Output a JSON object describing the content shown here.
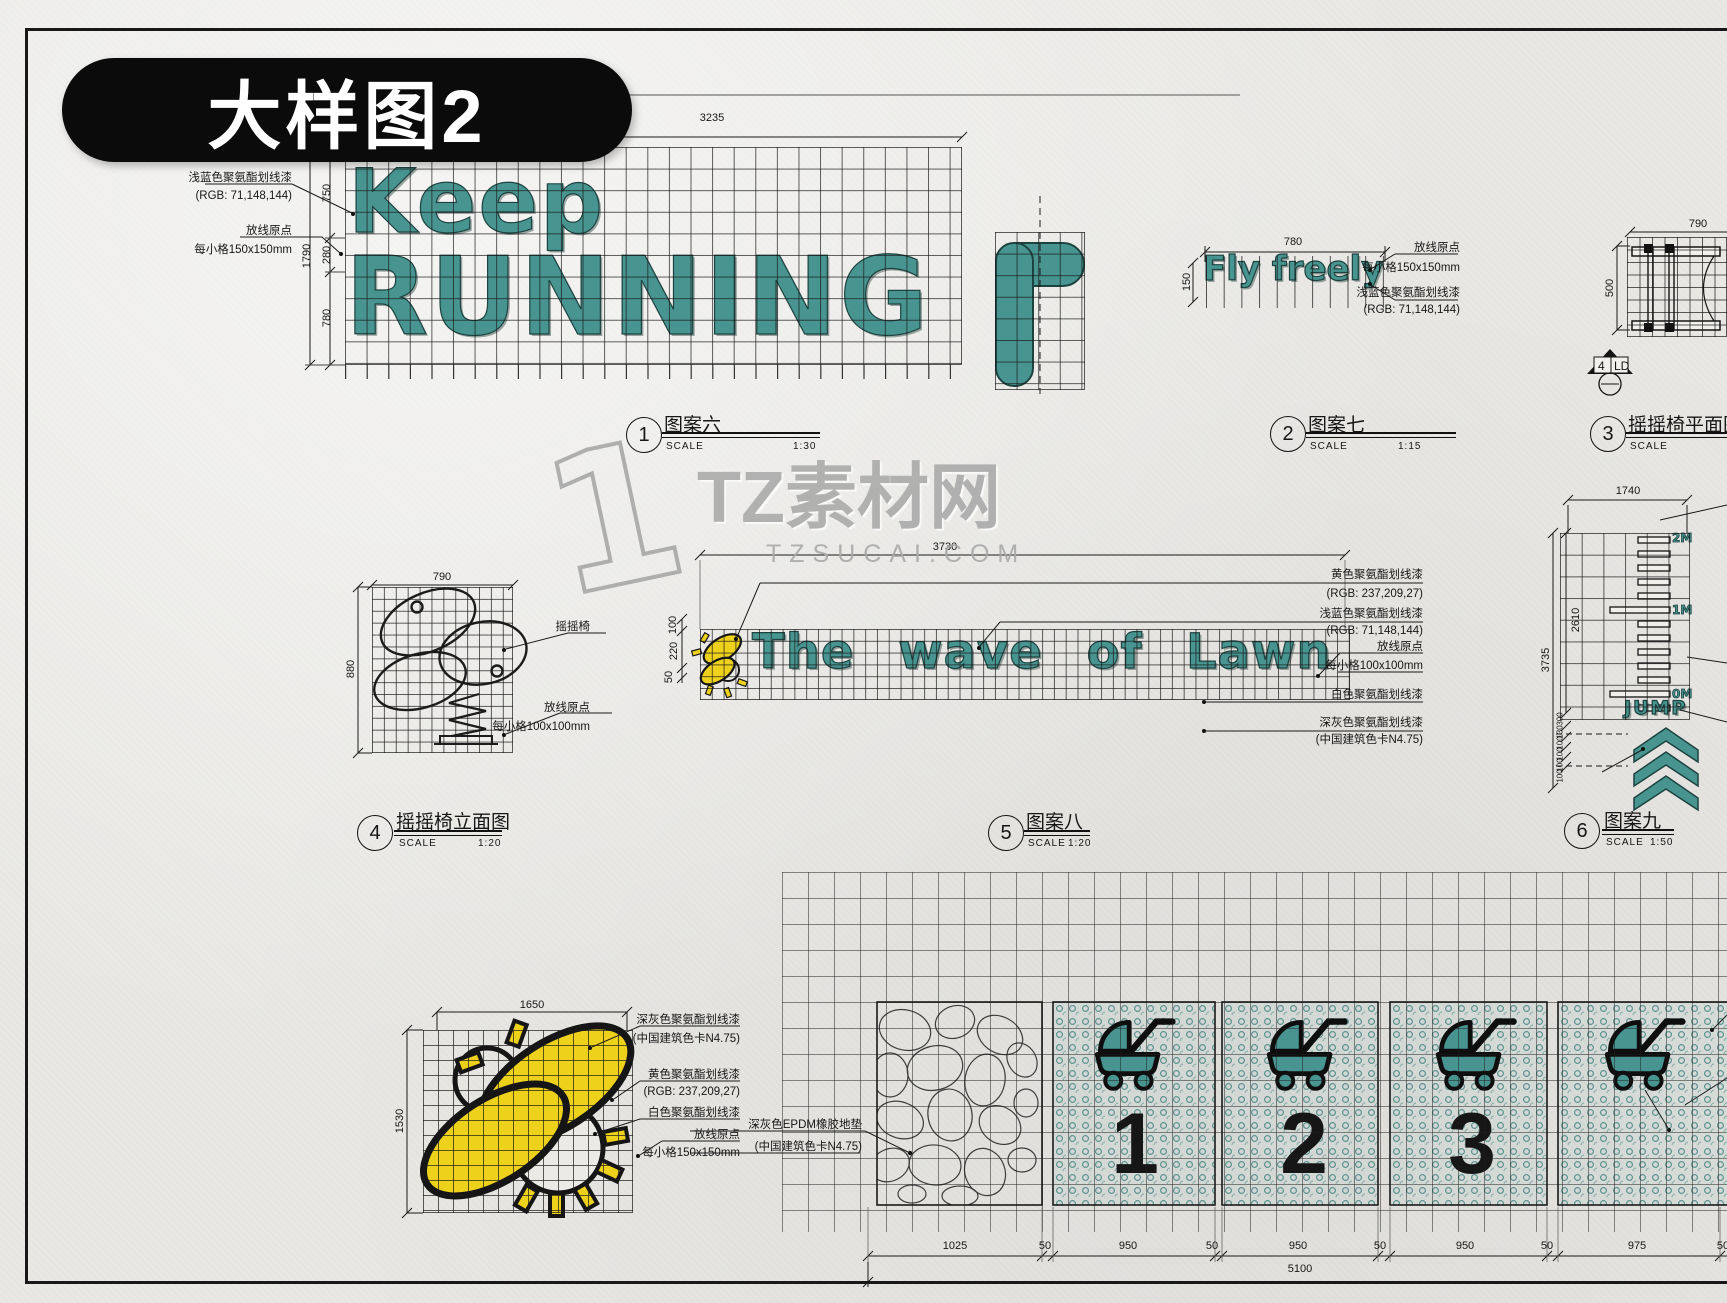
{
  "sheet": {
    "title": "大样图2"
  },
  "watermark": {
    "numeral": "1",
    "brand": "TZ素材网",
    "domain": "TZSUCAI.COM"
  },
  "colors": {
    "teal": "#479490",
    "yellow": "#edd11b",
    "paper": "#e9e8e5",
    "ink": "#161616"
  },
  "scale_word": "SCALE",
  "d1": {
    "num": "1",
    "title": "图案六",
    "scale": "1:30",
    "line1": "Keep",
    "line2": "RUNNING",
    "dim_top": "3235",
    "dim_750": "750",
    "dim_280": "280",
    "dim_780": "780",
    "dim_1790": "1790",
    "ann": [
      "浅蓝色聚氨酯划线漆",
      "(RGB: 71,148,144)",
      "放线原点",
      "每小格150x150mm"
    ]
  },
  "d2": {
    "num": "2",
    "title": "图案七",
    "scale": "1:15",
    "text": "Fly freely",
    "dim_top": "780",
    "dim_left": "150",
    "ann": [
      "放线原点",
      "每小格150x150mm",
      "浅蓝色聚氨酯划线漆",
      "(RGB: 71,148,144)"
    ]
  },
  "d3": {
    "num": "3",
    "title": "摇摇椅平面图",
    "scale": "",
    "dim_top": "790",
    "dim_left": "500",
    "marker_num": "4",
    "marker_code": "LD"
  },
  "d4": {
    "num": "4",
    "title": "摇摇椅立面图",
    "scale": "1:20",
    "dim_top": "790",
    "dim_left": "880",
    "ann": [
      "摇摇椅",
      "放线原点",
      "每小格100x100mm"
    ]
  },
  "d5": {
    "num": "5",
    "title": "图案八",
    "scale": "1:20",
    "text": "The wave of Lawn",
    "dim_top": "3730",
    "dims_left": [
      "100",
      "220",
      "50"
    ],
    "ann": [
      "黄色聚氨酯划线漆",
      "(RGB: 237,209,27)",
      "浅蓝色聚氨酯划线漆",
      "(RGB: 71,148,144)",
      "放线原点",
      "每小格100x100mm",
      "白色聚氨酯划线漆",
      "深灰色聚氨酯划线漆",
      "(中国建筑色卡N4.75)"
    ]
  },
  "d6": {
    "num": "6",
    "title": "图案九",
    "scale": "1:50",
    "dim_top": "1740",
    "dim_3735": "3735",
    "dim_2610": "2610",
    "dims_small": [
      "300",
      "130",
      "100",
      "100",
      "100",
      "100"
    ],
    "marks": [
      "2M",
      "1M",
      "0M"
    ],
    "jump": "JUMP"
  },
  "bee": {
    "dim_top": "1650",
    "dim_left": "1530",
    "ann": [
      "深灰色聚氨酯划线漆",
      "(中国建筑色卡N4.75)",
      "黄色聚氨酯划线漆",
      "(RGB: 237,209,27)",
      "白色聚氨酯划线漆",
      "放线原点",
      "每小格150x150mm"
    ]
  },
  "strip": {
    "numbers": [
      "1",
      "2",
      "3"
    ],
    "ann": [
      "深灰色EPDM橡胶地垫",
      "(中国建筑色卡N4.75)"
    ],
    "dims": [
      "1025",
      "50",
      "950",
      "50",
      "950",
      "50",
      "950",
      "50",
      "975",
      "50"
    ],
    "dim_total": "5100"
  },
  "icons": {
    "stroller": "stroller-icon",
    "chevron": "chevron-up-icon",
    "bee": "bee-icon",
    "rocking_chair": "rocking-chair-icon",
    "section_marker": "section-marker-icon"
  }
}
